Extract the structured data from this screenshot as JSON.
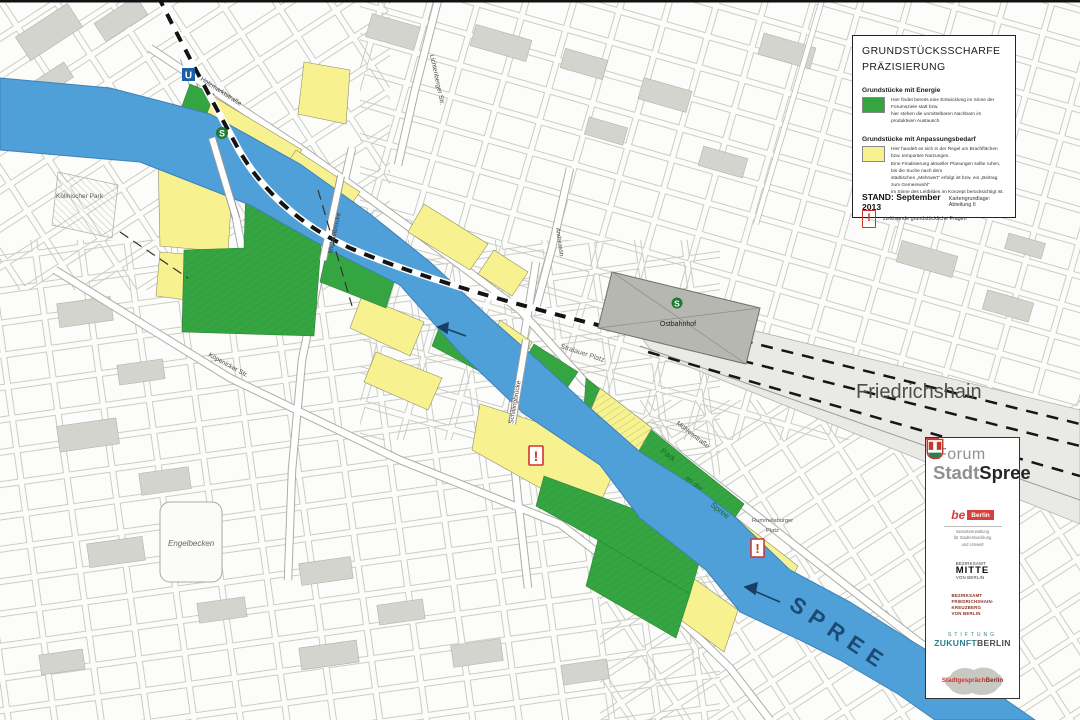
{
  "legend": {
    "title_line1": "GRUNDSTÜCKSSCHARFE",
    "title_line2": "PRÄZISIERUNG",
    "energy": {
      "heading": "Grundstücke mit Energie",
      "desc": [
        "Hier findet bereits eine Entwicklung im Sinne der Forumsziele statt bzw.",
        "hier stehen die unmittelbaren Nachbarn im produktiven Austausch."
      ]
    },
    "adapt": {
      "heading": "Grundstücke mit Anpassungsbedarf",
      "desc": [
        "Hier handelt es sich in der Regel um Brachflächen bzw. temporäre Nutzungen.",
        "Eine Finalisierung aktueller Planungen sollte ruhen, bis die Suche nach dem",
        "städtischen „Mehrwert“ erfolgt ist bzw. ein „Beitrag zum Gemeinwohl“",
        "im Sinne des Leitbildes im Konzept berücksichtigt ist."
      ]
    },
    "exclamation_symbol": "!",
    "exclamation_label": "zu lösende grundstückliche Fragen",
    "stand": "STAND: September 2013",
    "source": "Kartengrundlage: Abteilung II"
  },
  "forum": {
    "line1": "Forum",
    "stadt": "Stadt",
    "spree": "Spree",
    "be_berlin": {
      "be": "be",
      "berlin": "Berlin",
      "sub": [
        "Senatsverwaltung",
        "für Stadtentwicklung",
        "und Umwelt"
      ]
    },
    "mitte": {
      "l1": "BEZIRKSAMT",
      "l2": "MITTE",
      "l3": "VON BERLIN"
    },
    "fk": {
      "l1": "BEZIRKSAMT",
      "l2": "FRIEDRICHSHAIN-",
      "l3": "KREUZBERG",
      "l4": "VON BERLIN"
    },
    "stiftung": {
      "l1": "STIFTUNG",
      "zukunft": "ZUKUNFT",
      "berlin": "BERLIN"
    },
    "stadtgespraech": {
      "a": "Stadtgespräch",
      "b": "Berlin"
    }
  },
  "map": {
    "labels": [
      {
        "text": "Friedrichshain"
      },
      {
        "text": "SPREE"
      },
      {
        "text": "Ostbahnhof"
      },
      {
        "text": "Engelbecken"
      },
      {
        "text": "Köllnischer Park"
      },
      {
        "text": "Michaelbrücke"
      },
      {
        "text": "Schillingbrücke"
      },
      {
        "text": "Stralauer Platz"
      },
      {
        "text": "Mühlenstraße"
      },
      {
        "text": "Holzmarktstraße"
      },
      {
        "text": "Lichtenberger Str."
      },
      {
        "text": "Köpenicker Str."
      },
      {
        "text": "Andreasstr."
      },
      {
        "text": "Park"
      },
      {
        "text": "an der"
      },
      {
        "text": "Spree"
      },
      {
        "text": "Rummelsburger"
      },
      {
        "text": "Platz"
      }
    ],
    "symbols": {
      "u": "U",
      "s": "S"
    },
    "marker": "!"
  },
  "colors": {
    "parcel_green": "#35a542",
    "parcel_yellow": "#f7f28f",
    "river_blue": "#4f9fd8",
    "alert_red": "#d0342a"
  }
}
